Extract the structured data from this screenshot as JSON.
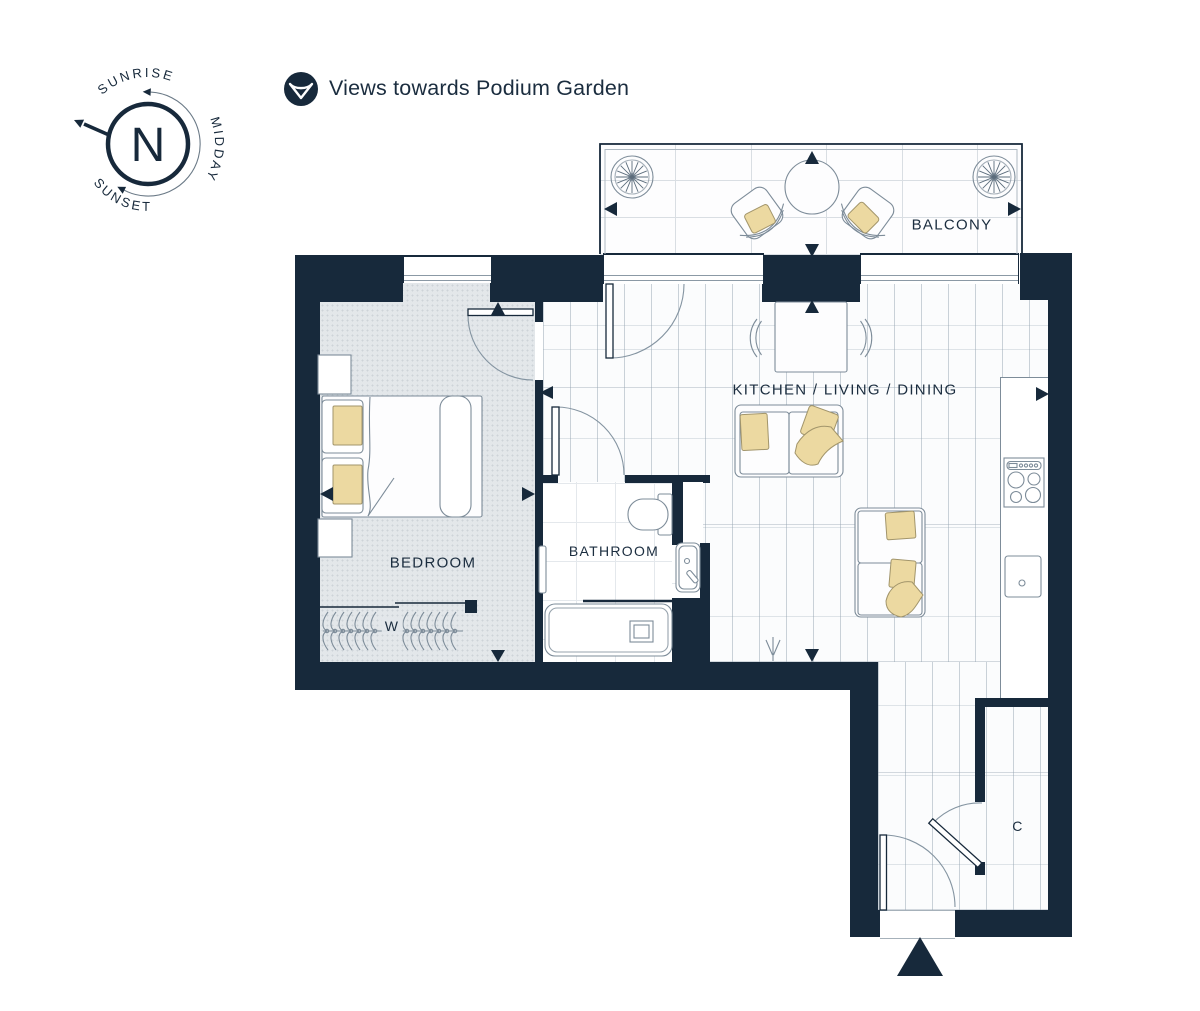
{
  "title": "Apartment floor plan",
  "legend": {
    "label": "Views towards Podium Garden"
  },
  "compass": {
    "north": "N",
    "sunrise": "SUNRISE",
    "midday": "MIDDAY",
    "sunset": "SUNSET"
  },
  "rooms": {
    "balcony": "BALCONY",
    "kitchen_living_dining": "KITCHEN / LIVING / DINING",
    "bedroom": "BEDROOM",
    "bathroom": "BATHROOM",
    "wardrobe": "W",
    "cupboard": "C"
  },
  "colors": {
    "wall": "#17293b",
    "outline": "#7d8c99",
    "cushion": "#ecd9a1",
    "cushion_outline": "#a2956b",
    "carpet": "#e3e7ea",
    "text": "#1b2d3f"
  }
}
